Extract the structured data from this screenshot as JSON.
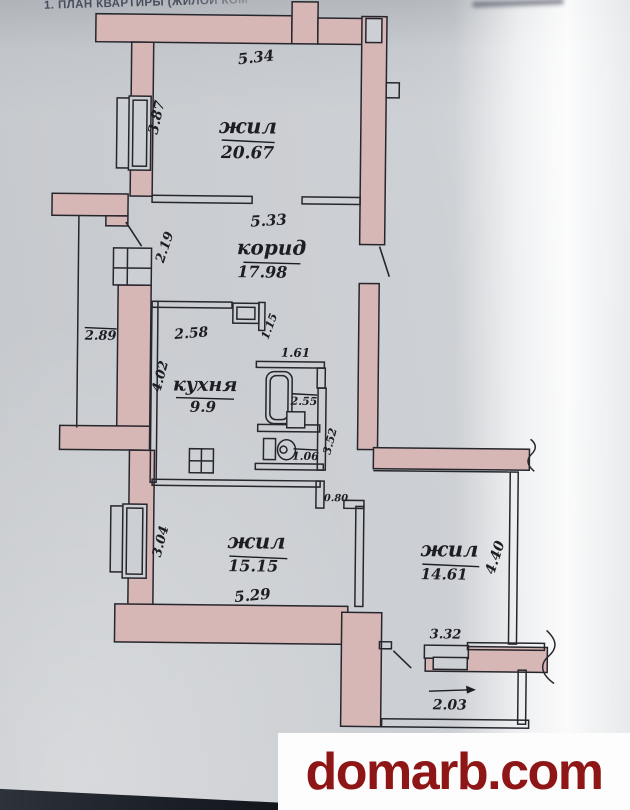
{
  "header": {
    "title": "1. ПЛАН КВАРТИРЫ (ЖИЛОЙ КОМ"
  },
  "watermark": {
    "text": "domarb.com",
    "color": "#8e1616"
  },
  "plan": {
    "wall_color": "#d7b6b6",
    "ink_color": "#26262d",
    "rooms": {
      "living_top": {
        "name": "жил",
        "area": "20.67"
      },
      "corridor": {
        "name": "корид",
        "area": "17.98"
      },
      "kitchen": {
        "name": "кухня",
        "area": "9.9"
      },
      "living_left": {
        "name": "жил",
        "area": "15.15"
      },
      "living_right": {
        "name": "жил",
        "area": "14.61"
      }
    },
    "dims": {
      "top_width": "5.34",
      "top_height": "3.87",
      "corridor_width": "5.33",
      "corridor_depth": "2.19",
      "left_side": "2.89",
      "kitchen_width": "2.58",
      "kitchen_depth": "4.02",
      "niche": "1.15",
      "bath_width": "1.61",
      "bath_length": "2.55",
      "inner_hall": "3.52",
      "wc_width": "1.06",
      "passage": "0.80",
      "left_room_depth": "3.04",
      "left_room_width": "5.29",
      "right_room_depth": "4.40",
      "right_room_width": "3.32",
      "balcony_width": "2.03"
    }
  }
}
